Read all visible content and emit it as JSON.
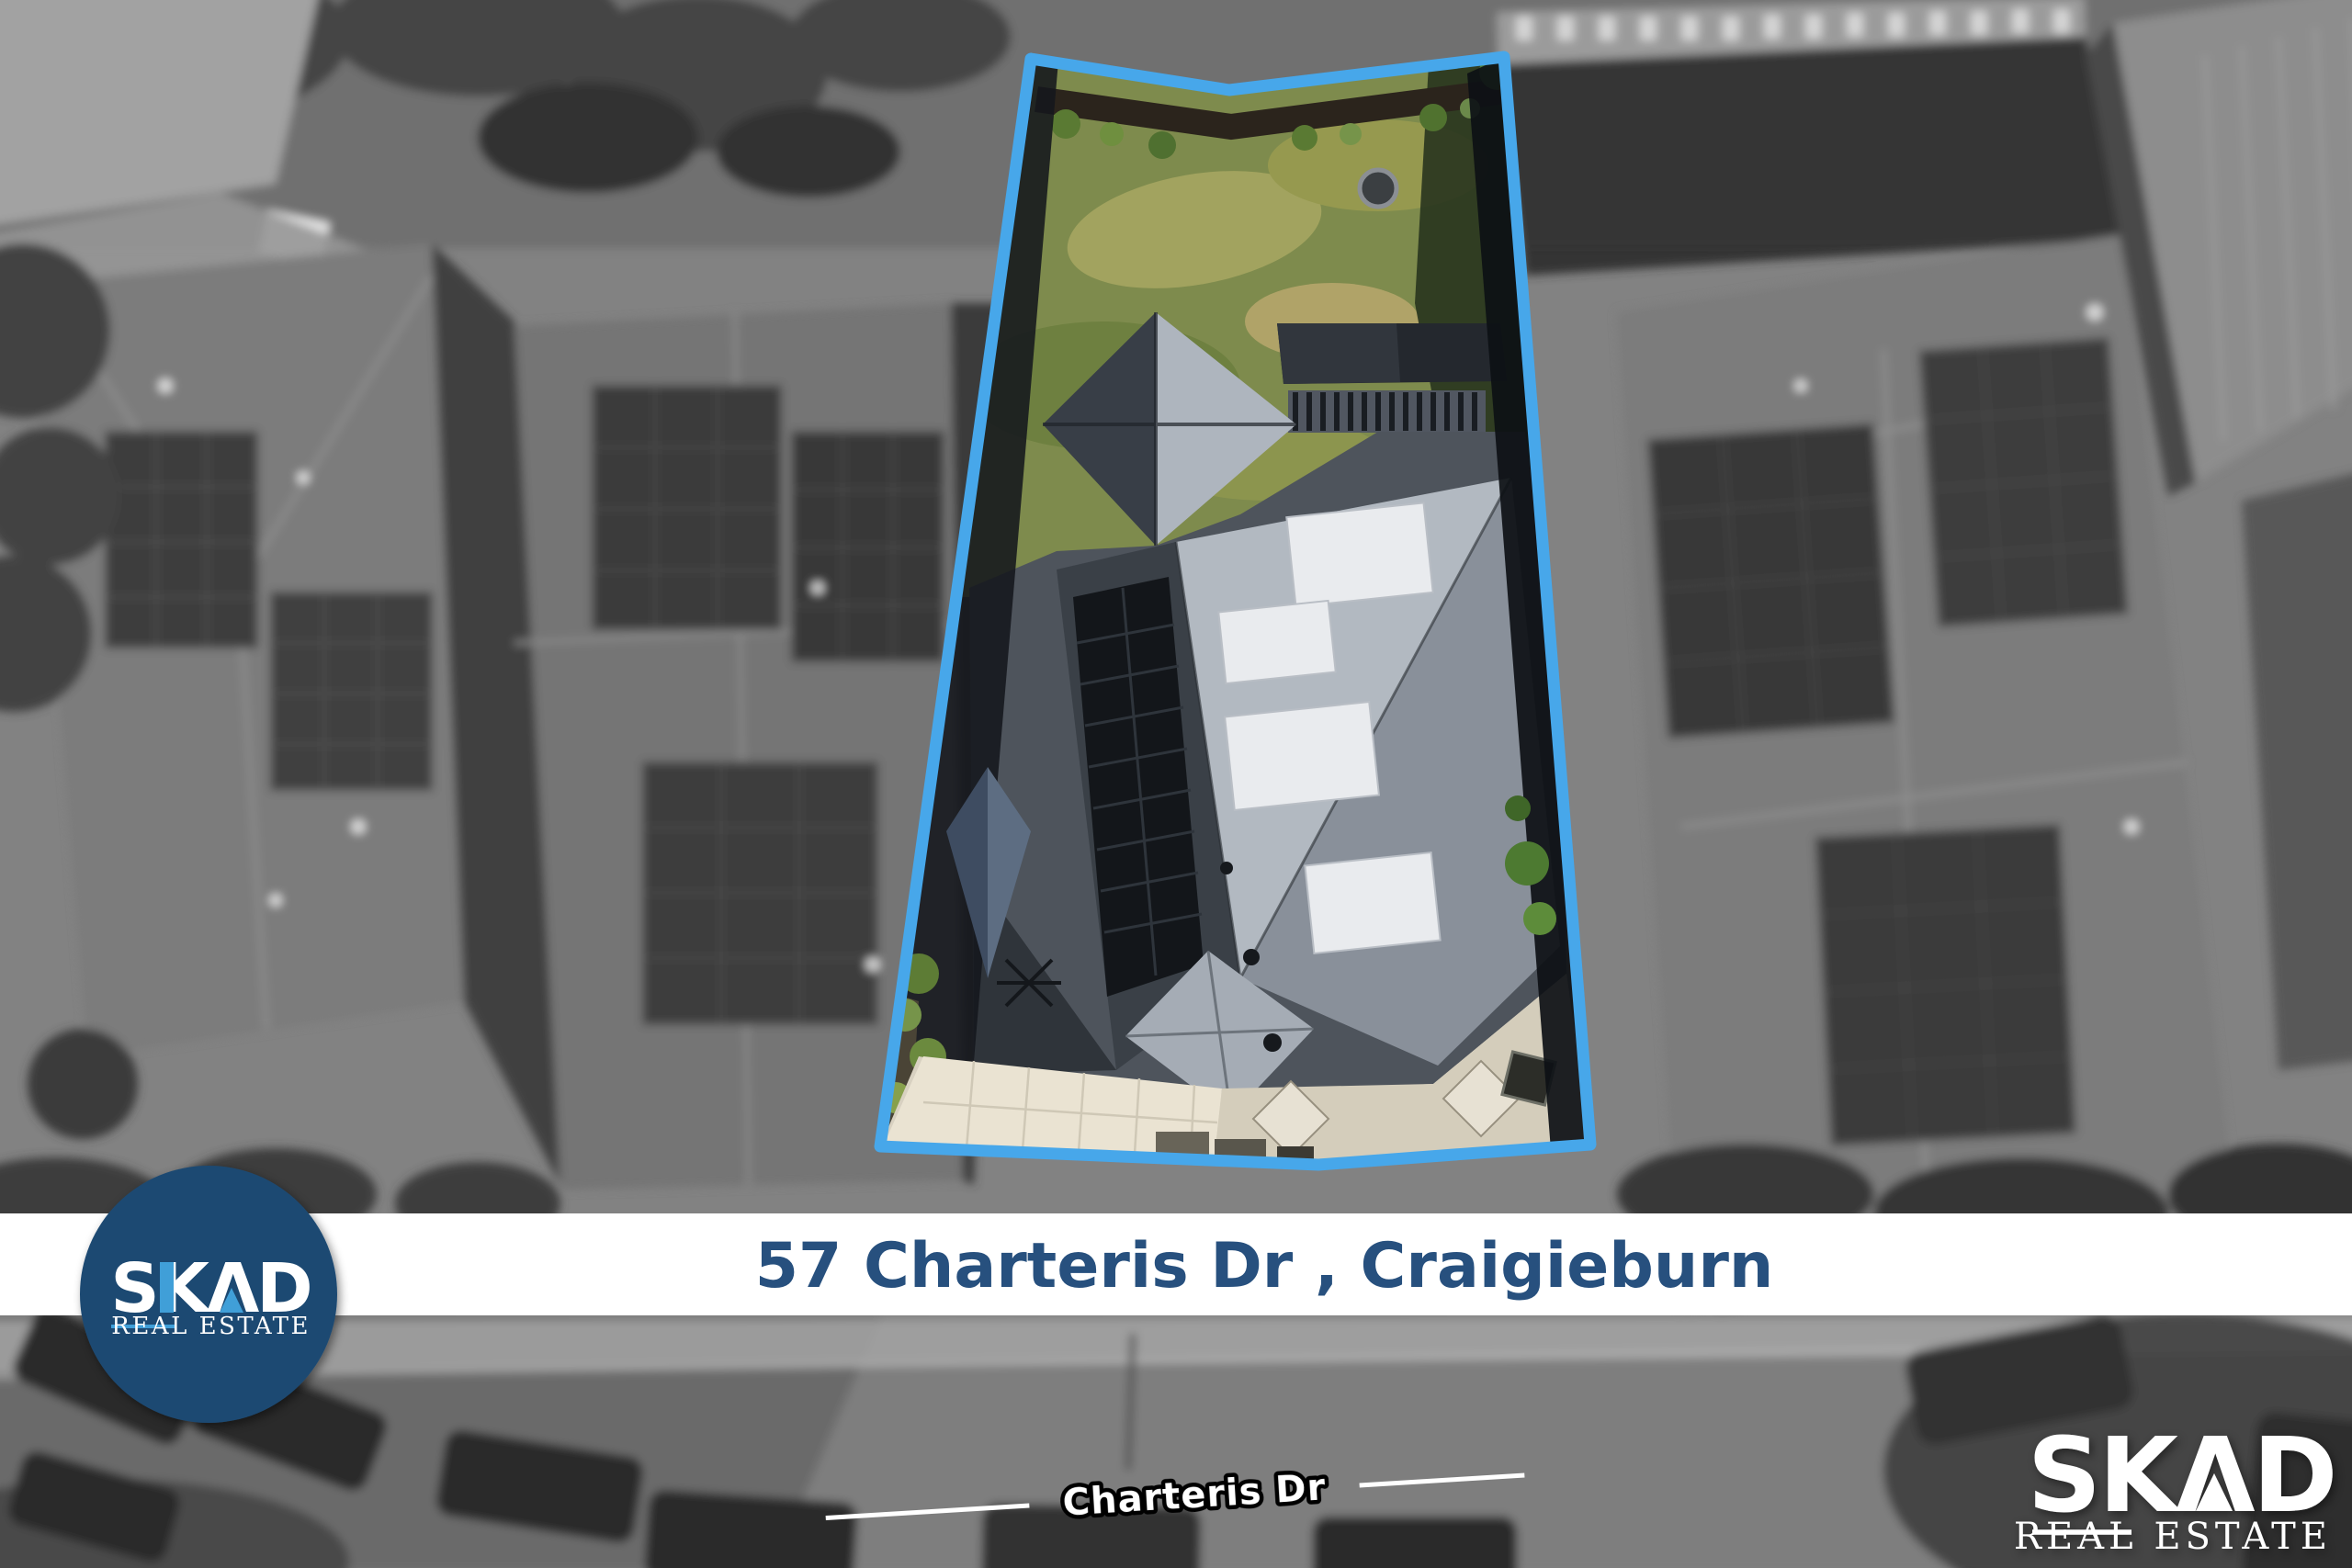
{
  "image": {
    "kind": "real-estate aerial drone photo",
    "note": "greyscale suburb, highlighted lot shown in colour inside blue boundary"
  },
  "banner": {
    "address": "57 Charteris Dr , Craigieburn",
    "background_color": "#ffffff",
    "text_color": "#27507e"
  },
  "badge": {
    "brand": "SKAD",
    "display_word": "SKΛD",
    "tagline": "REAL ESTATE",
    "circle_color": "#1e4a72",
    "accent_color": "#3f9fd8",
    "text_color": "#ffffff"
  },
  "watermark": {
    "brand": "SKAD",
    "display_word": "SKΛD",
    "tagline": "REAL ESTATE",
    "text_color": "#ffffff"
  },
  "street_label": {
    "text": "Charteris Dr",
    "text_color": "#ffffff",
    "outline_color": "#000000",
    "line_color": "#ffffff"
  },
  "boundary": {
    "color": "#47a7ea"
  }
}
